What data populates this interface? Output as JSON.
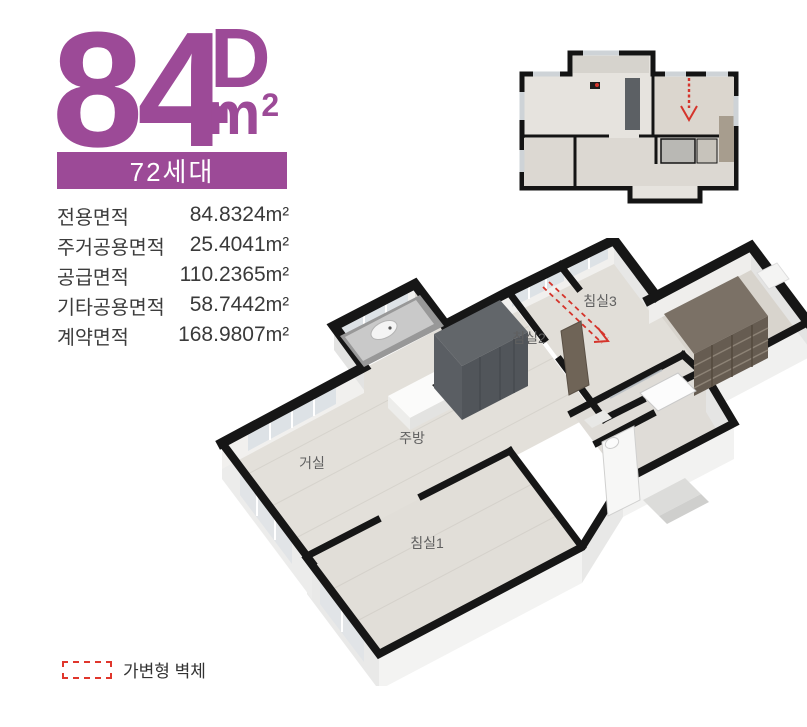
{
  "unit": {
    "number": "84",
    "type_letter": "D",
    "unit_m": "m",
    "unit_exp": "2",
    "households_badge": "72세대"
  },
  "area_table": {
    "rows": [
      {
        "label": "전용면적",
        "value": "84.8324",
        "unit": "m²"
      },
      {
        "label": "주거공용면적",
        "value": "25.4041",
        "unit": "m²"
      },
      {
        "label": "공급면적",
        "value": "110.2365",
        "unit": "m²"
      },
      {
        "label": "기타공용면적",
        "value": "58.7442",
        "unit": "m²"
      },
      {
        "label": "계약면적",
        "value": "168.9807",
        "unit": "m²"
      }
    ]
  },
  "floorplan3d": {
    "rooms": [
      {
        "id": "living",
        "label": "거실"
      },
      {
        "id": "kitchen",
        "label": "주방"
      },
      {
        "id": "bedroom1",
        "label": "침실1"
      },
      {
        "id": "bedroom2",
        "label": "침실2"
      },
      {
        "id": "bedroom3",
        "label": "침실3"
      }
    ]
  },
  "legend": {
    "label": "가변형 벽체"
  },
  "colors": {
    "accent_purple": "#9c4a97",
    "text_dark": "#3c3c3c",
    "wall_black": "#161616",
    "floor_light": "#e3e0da",
    "variable_wall_red": "#d5342b"
  }
}
